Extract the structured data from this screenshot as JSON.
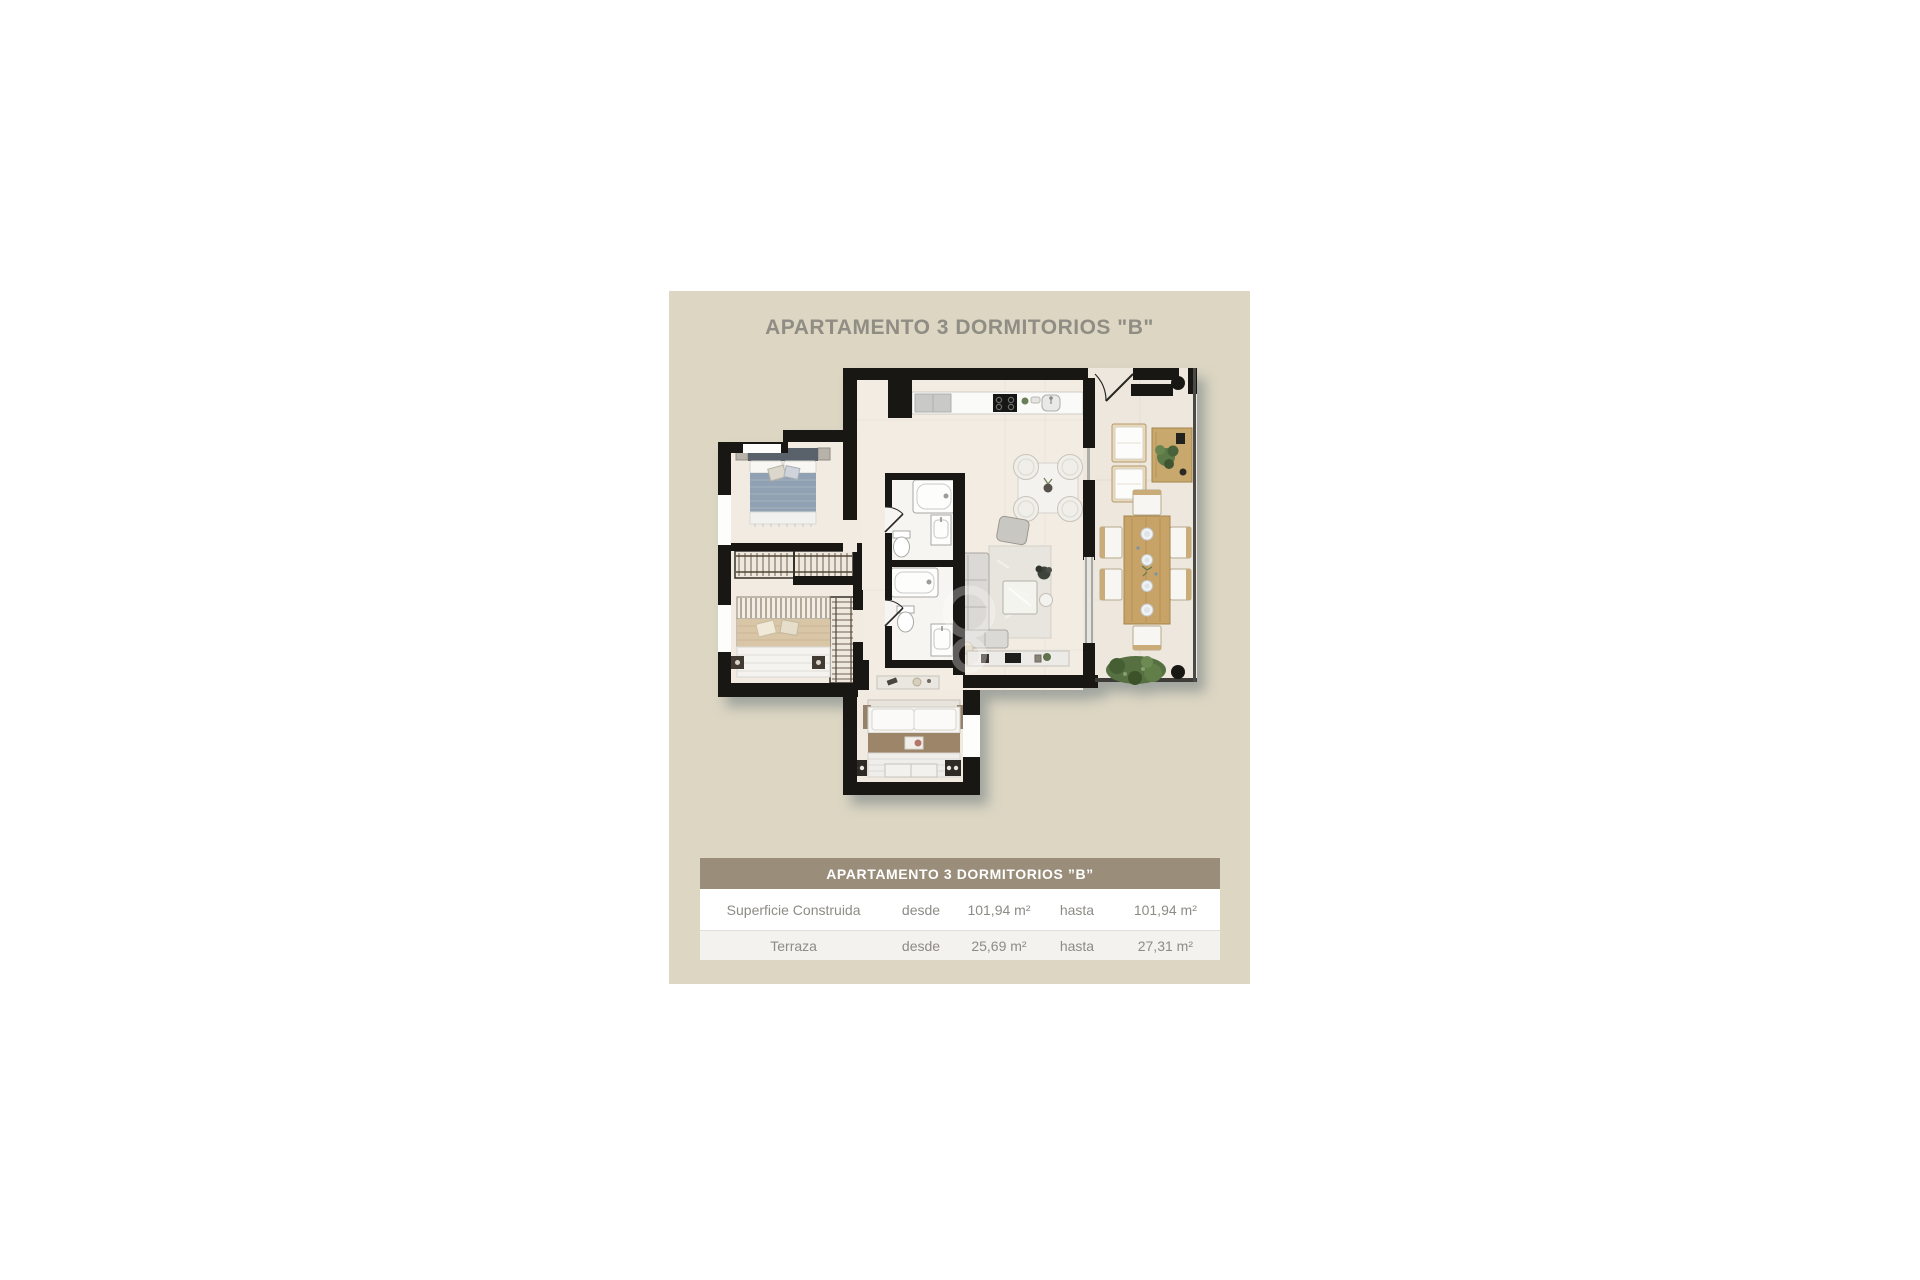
{
  "panel": {
    "title": "APARTAMENTO 3 DORMITORIOS \"B\"",
    "background": "#dcd6c3"
  },
  "floorplan": {
    "wall_color": "#191714",
    "floor_color": "#f2ece3",
    "terrace_floor_color": "#eee7dd",
    "shadow_color": "rgba(112,124,127,0.55)",
    "elements": [
      "bedroom-1-double-bed-blue",
      "bedroom-2-double-bed-beige",
      "bedroom-3-double-bed-brown",
      "wardrobe-units",
      "bathroom-1",
      "bathroom-2",
      "kitchen-counter",
      "indoor-dining-table",
      "sofa",
      "coffee-table",
      "tv-console",
      "terrace-lounge-chairs",
      "terrace-sideboard",
      "terrace-dining-table",
      "terrace-plant",
      "entry-door",
      "columns"
    ]
  },
  "spec_table": {
    "header": "APARTAMENTO 3 DORMITORIOS ”B”",
    "header_bg": "#9a8e7b",
    "rows": [
      {
        "label": "Superficie Construida",
        "desde": "desde",
        "desde_value": "101,94 m²",
        "hasta": "hasta",
        "hasta_value": "101,94 m²"
      },
      {
        "label": "Terraza",
        "desde": "desde",
        "desde_value": "25,69 m²",
        "hasta": "hasta",
        "hasta_value": "27,31 m²"
      }
    ]
  }
}
